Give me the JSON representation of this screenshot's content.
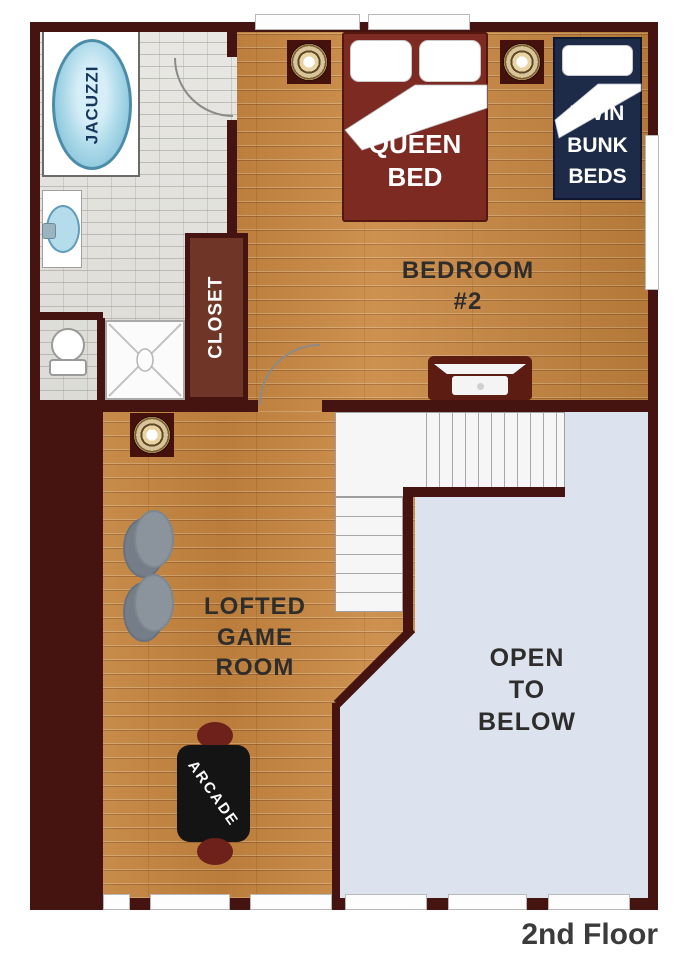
{
  "title": "2nd Floor plan",
  "floor_label": "2nd Floor",
  "labels": {
    "jacuzzi": "JACUZZI",
    "closet": "CLOSET",
    "queen_bed": "QUEEN\nBED",
    "twin_bunk_beds": "TWIN\nBUNK\nBEDS",
    "bedroom2": "BEDROOM\n#2",
    "game_room": "LOFTED\nGAME\nROOM",
    "open_below": "OPEN\nTO\nBELOW",
    "arcade": "ARCADE"
  },
  "colors": {
    "wall": "#451410",
    "wood_floor": "#c8863f",
    "tile_floor": "#e3e2de",
    "open_area": "#dce3ef",
    "queen_bed": "#7d2b22",
    "bunk_bed": "#1d2b48",
    "closet": "#6f3628",
    "jacuzzi_water": "#a9d8e8",
    "stool": "#8b949d",
    "arcade_cabinet": "#141414",
    "text": "#2e2d2b"
  }
}
